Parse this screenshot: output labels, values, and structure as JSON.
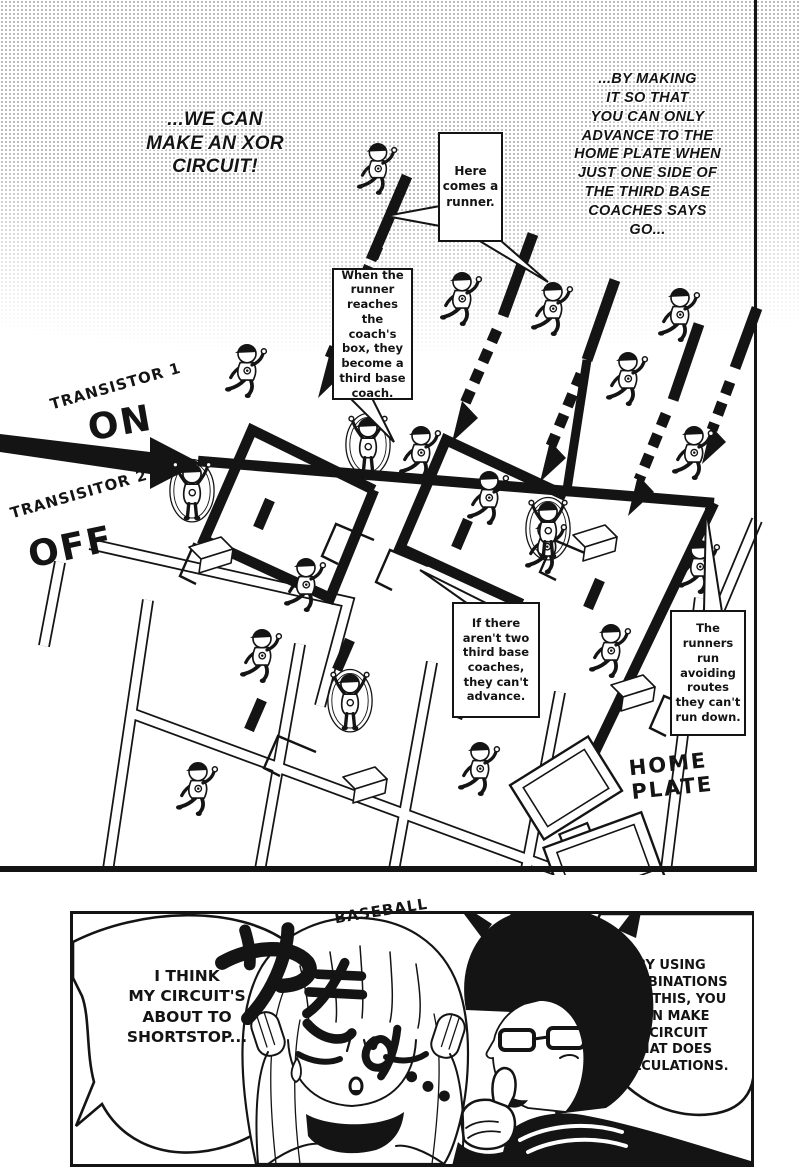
{
  "panel1": {
    "caption_left": "...WE CAN\nMAKE AN XOR\nCIRCUIT!",
    "caption_right": "...BY MAKING\nIT SO THAT\nYOU CAN ONLY\nADVANCE TO THE\nHOME PLATE WHEN\nJUST ONE SIDE OF\nTHE THIRD BASE\nCOACHES SAYS\nGO...",
    "callout_runner": "Here\ncomes a\nrunner.",
    "callout_coach": "When the\nrunner\nreaches\nthe coach's\nbox, they\nbecome a\nthird base\ncoach.",
    "callout_advance": "If there\naren't two\nthird base\ncoaches,\nthey can't\nadvance.",
    "callout_avoid": "The\nrunners\nrun\navoiding\nroutes\nthey can't\nrun down.",
    "label_transistor1": "TRANSISTOR 1",
    "label_transistor1_state": "ON",
    "label_transistor2": "TRANSISITOR 2",
    "label_transistor2_state": "OFF",
    "label_home_plate": "HOME\nPLATE"
  },
  "panel2": {
    "sfx_jp": "やきゅ...",
    "sfx_en": "BASEBALL",
    "bubble_left": "I THINK\nMY CIRCUIT'S\nABOUT TO\nSHORTSTOP...",
    "bubble_right": "BY USING\nCOMBINATIONS\nLIKE THIS, YOU\nCAN MAKE\nA CIRCUIT\nTHAT DOES\nCALCULATIONS."
  },
  "colors": {
    "ink": "#141414",
    "paper": "#ffffff",
    "tone_dot": "#8f8f8f"
  }
}
